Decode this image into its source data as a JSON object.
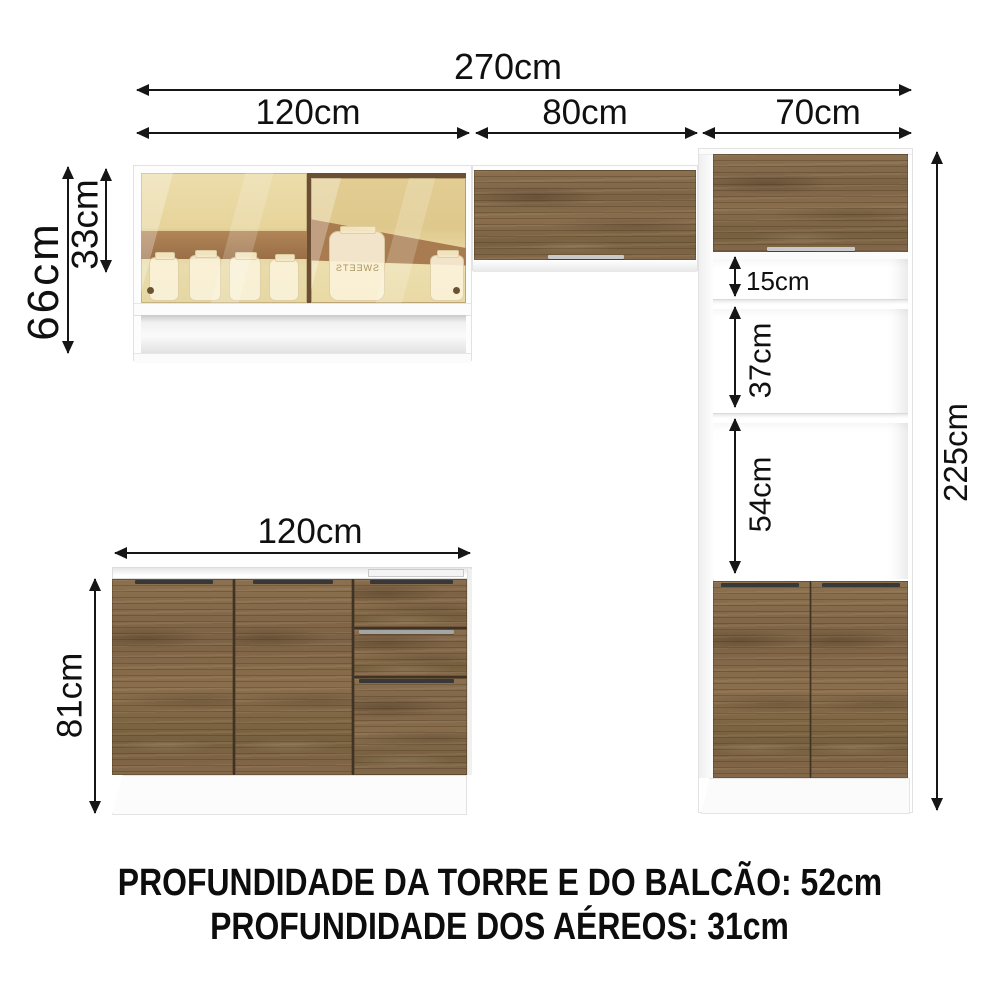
{
  "diagram": {
    "top": {
      "total_width": "270cm",
      "section_left": "120cm",
      "section_middle": "80cm",
      "section_right": "70cm"
    },
    "wall_cabinet": {
      "height": "66cm",
      "door_height": "33cm",
      "jar_label": "SWEETS"
    },
    "tower": {
      "gap_top": "15cm",
      "gap_middle": "37cm",
      "gap_bottom": "54cm",
      "total_height": "225cm"
    },
    "counter": {
      "width": "120cm",
      "height": "81cm"
    },
    "footer": {
      "line1": "PROFUNDIDADE DA TORRE E DO BALCÃO: 52cm",
      "line2": "PROFUNDIDADE DOS AÉREOS: 31cm"
    },
    "colors": {
      "wood": "#84684a",
      "glass": "#e6d29a",
      "interior_brown": "#a87c50",
      "dimension_line": "#161616",
      "cabinet_white": "#fcfcfc"
    }
  }
}
